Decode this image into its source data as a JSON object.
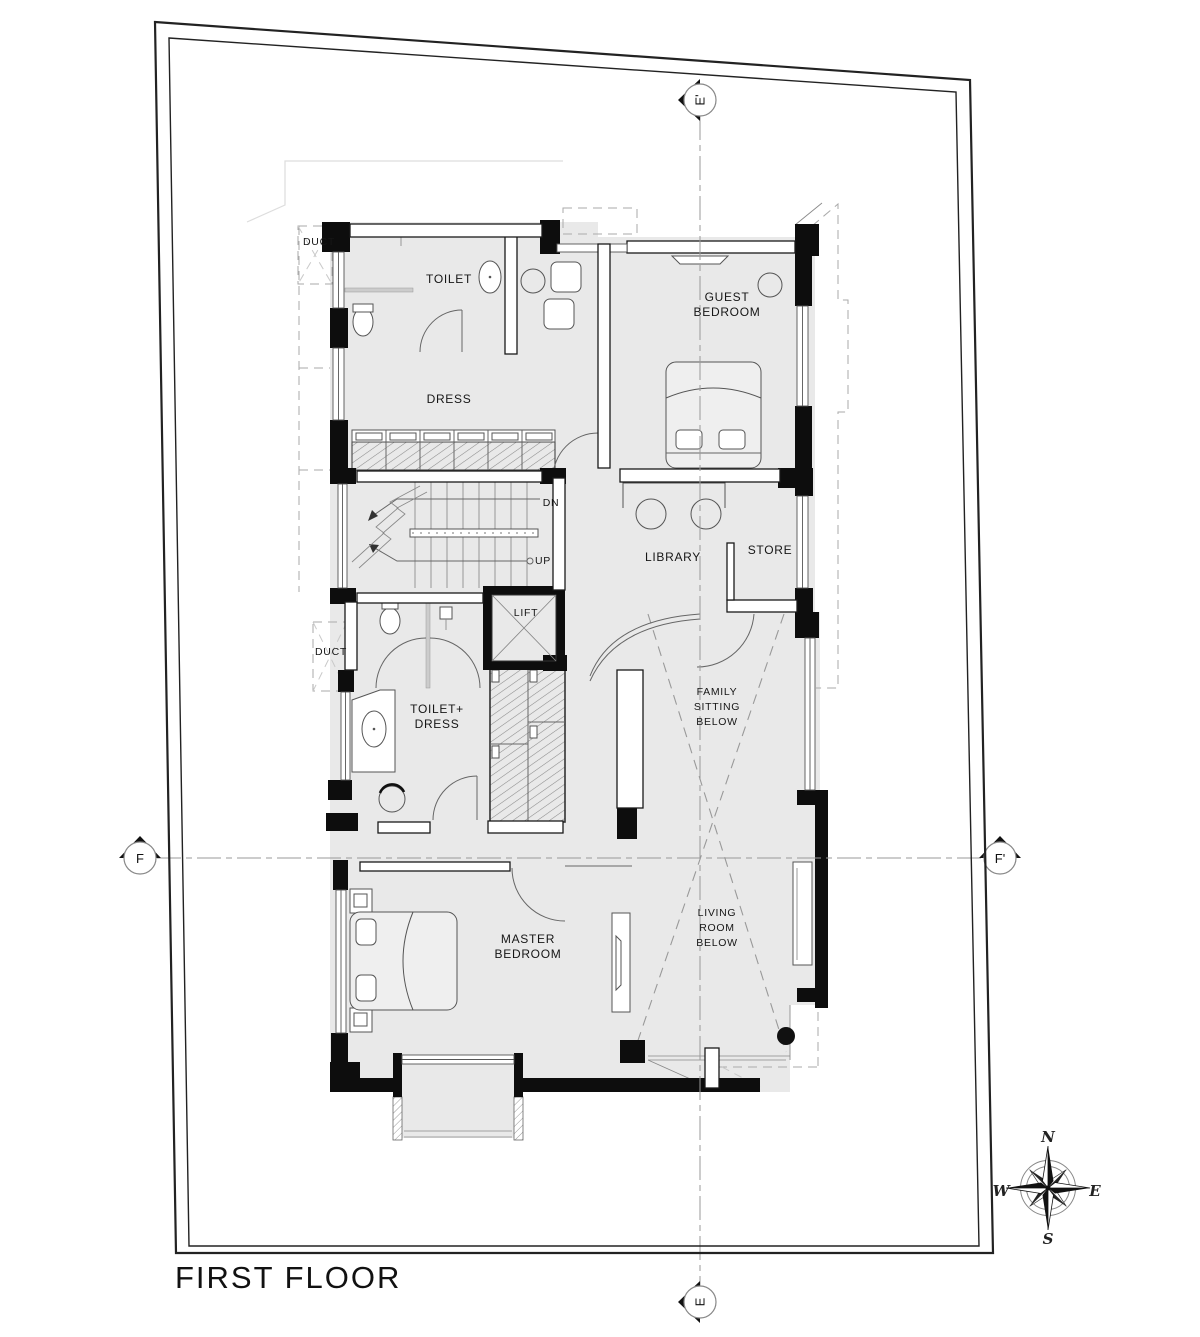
{
  "title": "FIRST FLOOR",
  "grid": {
    "top": "E'",
    "bottom": "E",
    "left": "F",
    "right": "F'"
  },
  "rooms": {
    "duct_top": "DUCT",
    "toilet": "TOILET",
    "dress": "DRESS",
    "guest": {
      "l1": "GUEST",
      "l2": "BEDROOM"
    },
    "stair_dn": "DN",
    "stair_up": "UP",
    "library": "LIBRARY",
    "store": "STORE",
    "lift": "LIFT",
    "duct_mid": "DUCT",
    "toilet_dress": {
      "l1": "TOILET+",
      "l2": "DRESS"
    },
    "family": {
      "l1": "FAMILY",
      "l2": "SITTING",
      "l3": "BELOW"
    },
    "master": {
      "l1": "MASTER",
      "l2": "BEDROOM"
    },
    "living": {
      "l1": "LIVING",
      "l2": "ROOM",
      "l3": "BELOW"
    }
  },
  "compass": {
    "n": "N",
    "s": "S",
    "e": "E",
    "w": "W"
  },
  "colors": {
    "floor": "#e9e9e9",
    "wall": "#0d0d0d",
    "paper": "#ffffff",
    "dash": "#aaaaaa"
  }
}
